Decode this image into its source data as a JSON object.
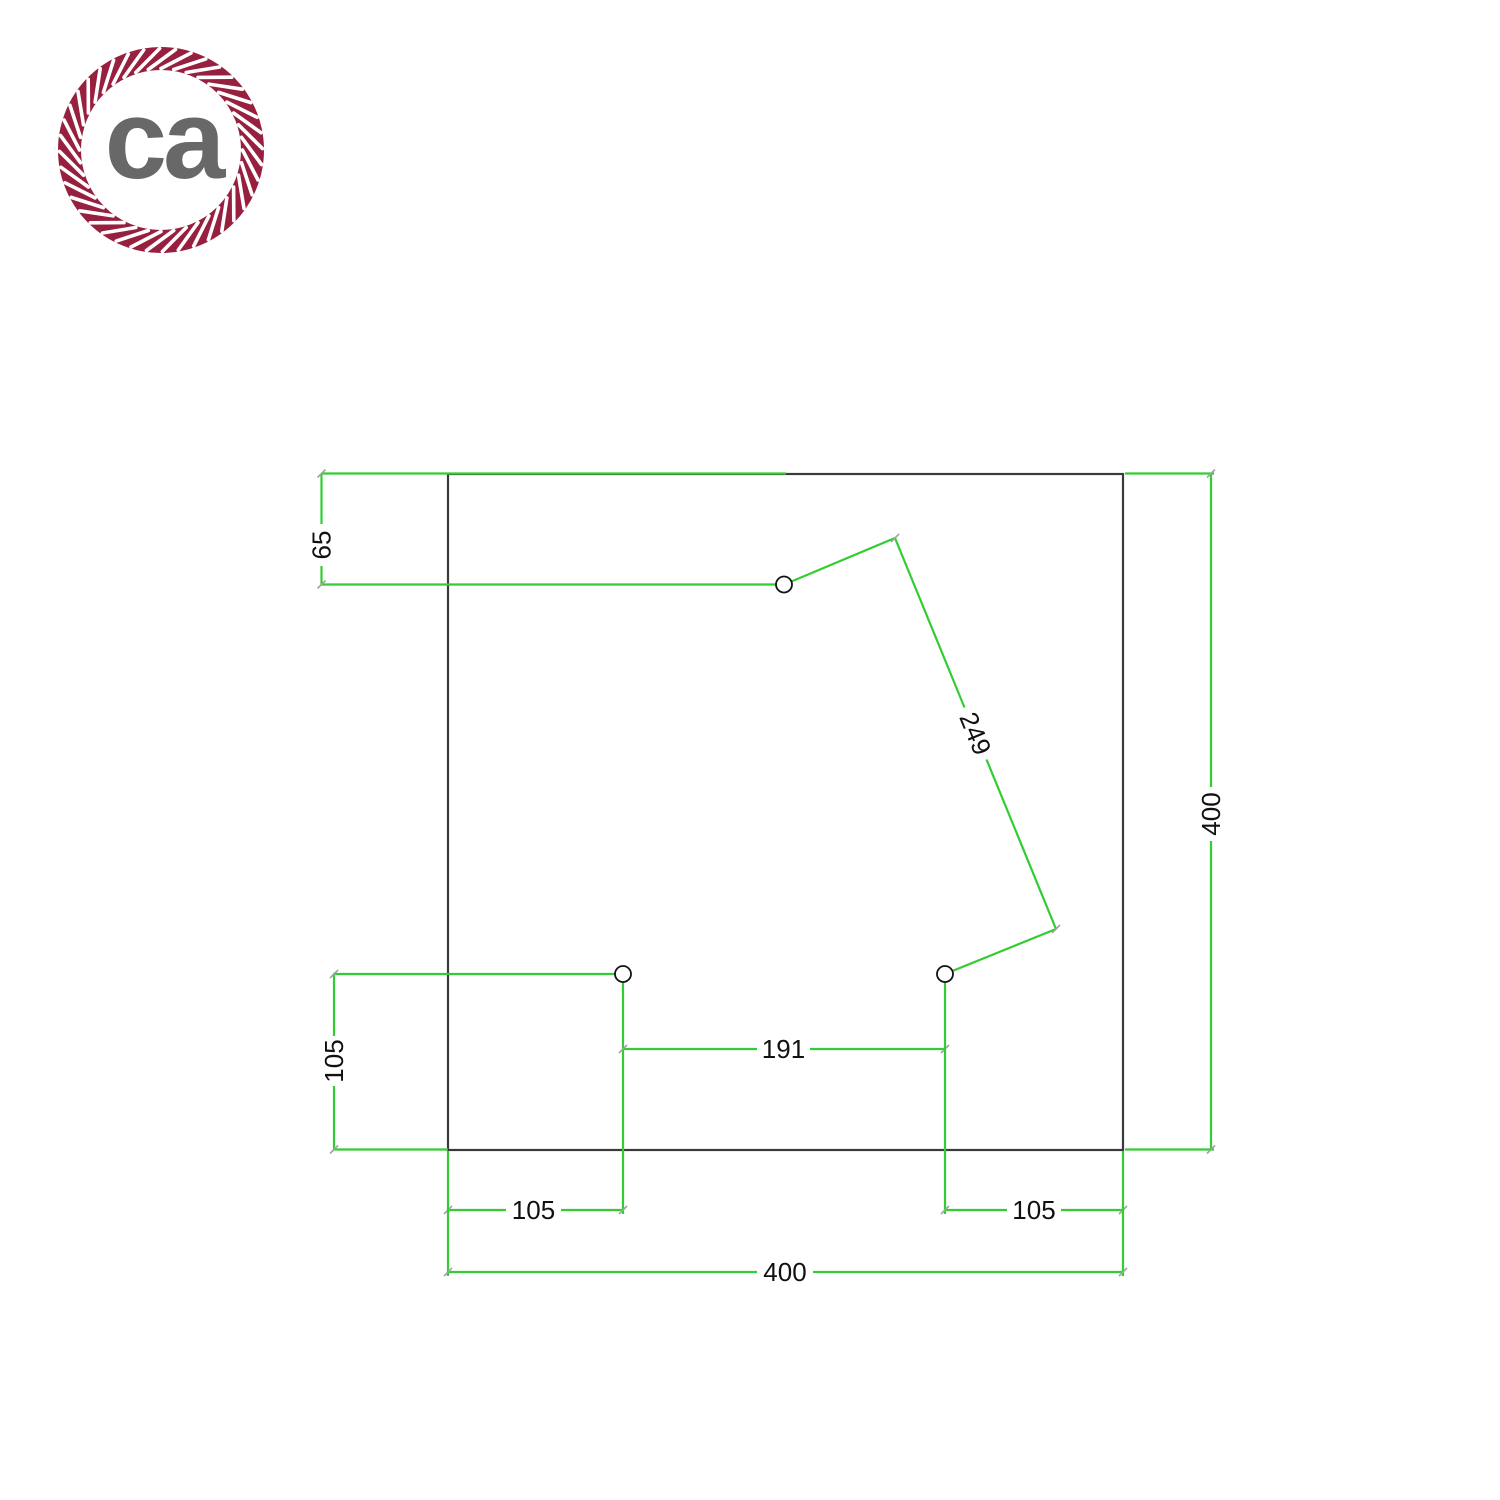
{
  "logo": {
    "text": "ca"
  },
  "dimensions": {
    "top_hole_offset": "65",
    "left_hole_to_bottom_edge": "105",
    "bottom_left_hole_x": "105",
    "bottom_holes_spacing": "191",
    "bottom_right_hole_x": "105",
    "plate_width": "400",
    "plate_height": "400",
    "top_to_bottom_right_hole_distance": "249"
  },
  "colors": {
    "dimension_green": "#33cc33",
    "outline_dark": "#3a3a3a",
    "tick_gray": "#9aa89a",
    "dim_text": "#111111",
    "rope_maroon": "#97203f",
    "logo_text_gray": "#686868"
  }
}
